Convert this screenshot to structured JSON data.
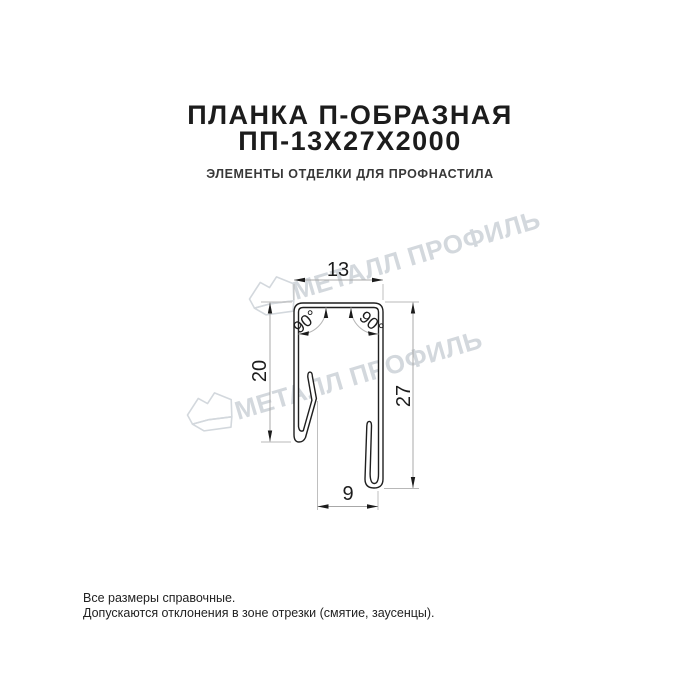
{
  "header": {
    "title_line1": "ПЛАНКА П-ОБРАЗНАЯ",
    "title_line2": "ПП-13Х27Х2000",
    "subtitle": "ЭЛЕМЕНТЫ ОТДЕЛКИ ДЛЯ ПРОФНАСТИЛА"
  },
  "drawing": {
    "type": "profile-cross-section",
    "dimensions": {
      "top_width": "13",
      "left_height": "20",
      "right_height": "27",
      "bottom_width": "9",
      "angle_left": "90°",
      "angle_right": "90°"
    }
  },
  "watermark": {
    "text": "МЕТАЛЛ ПРОФИЛЬ",
    "logo": "metal-profile-sheet-logo"
  },
  "footer": {
    "line1": "Все размеры справочные.",
    "line2": "Допускаются отклонения в зоне отрезки (смятие, заусенцы)."
  },
  "colors": {
    "background": "#ffffff",
    "ink": "#1c1c1c",
    "dimension_lines": "#a8a8a8",
    "watermark": "#d3d8dd"
  }
}
